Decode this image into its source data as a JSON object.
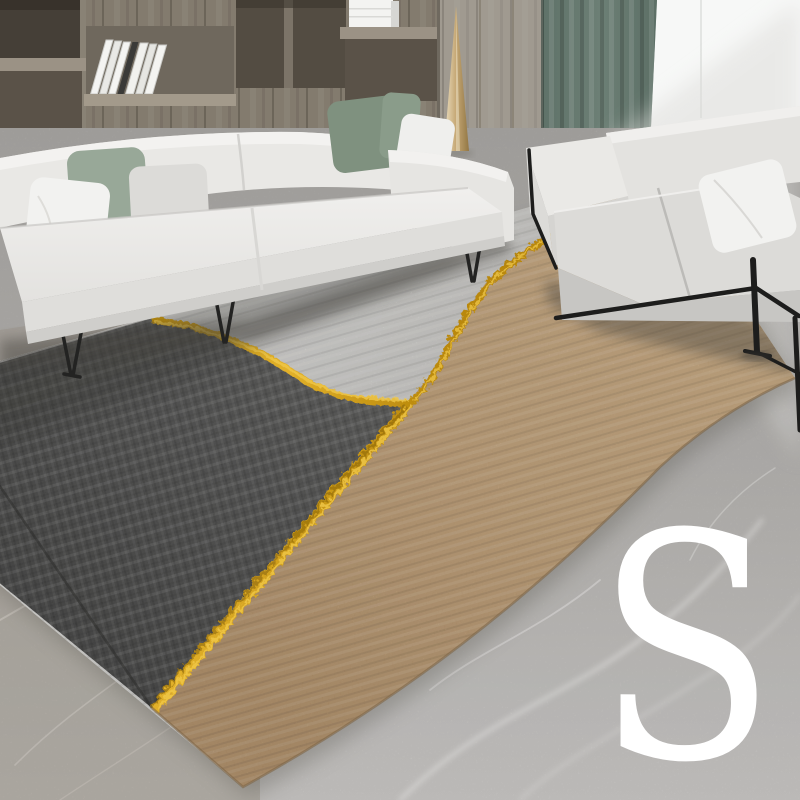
{
  "size_label": {
    "text": "S"
  },
  "scene": {
    "description": "Modern living room product photo: white fabric sofa with sage and white pillows in front of a wooden shelf wall, second white loveseat with black metal frame by a bright window with a green curtain, gold cone floor decor, gray marble floor, and a large area rug in charcoal / light gray / camel separated by wavy gold lines. White letter S size marker at bottom right.",
    "colors": {
      "rug_dark": "#4a4a49",
      "rug_light": "#cfcecb",
      "rug_tan": "#bd9c73",
      "rug_gold": "#d9a81e",
      "rug_gold_dark": "#8a660a",
      "curtain": "#66796f",
      "window": "#f7f8f7",
      "sofa": "#e9e8e5",
      "sofa_shade": "#dfdedb",
      "pillow_sage": "#8a9c8a",
      "pillow_white": "#f2f2f0",
      "pillow_gray": "#dcdbd8",
      "frame_black": "#1d1d1c",
      "wood_shelf": "#847c6f",
      "wood_panel": "#9e978d",
      "gold_decor": "#c2a36b",
      "floor": "#b5b3b0",
      "floor_warm": "#a69e94",
      "marble_vein": "#efeeec",
      "size_letter": "#ffffff"
    }
  }
}
